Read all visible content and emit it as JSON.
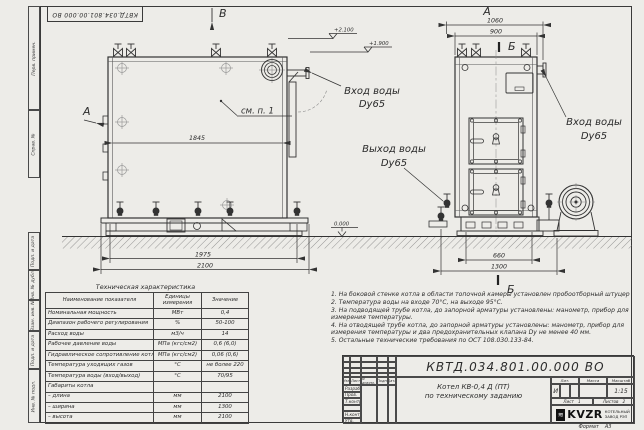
{
  "page": {
    "paper_color": "#edece8",
    "line_color": "#333333"
  },
  "stamp": {
    "text": "КВТД.034.801.00.000 ВО"
  },
  "frame": {
    "cells": [
      "Перв. примен.",
      "Справ. №",
      "Подп. и дата",
      "Инв. № дубл.",
      "Взам. инв. №",
      "Подп. и дата",
      "Инв. № подл."
    ]
  },
  "views": {
    "side": {
      "view_letter": "В",
      "arrow_letter": "А",
      "note_ref": "см. п. 1",
      "dim_inner": "1845",
      "dim_base": "1975",
      "dim_overall": "2100",
      "elev_top": "+2.100",
      "elev_inlet": "+1.900",
      "elev_zero": "0.000",
      "inlet_line1": "Вход воды",
      "inlet_line2": "Dy65"
    },
    "front": {
      "view_letter": "А",
      "section_letter": "Б",
      "dim_overall_top": "1060",
      "dim_body": "900",
      "dim_base": "660",
      "dim_overall_bottom": "1300",
      "inlet_line1": "Вход воды",
      "inlet_line2": "Dy65",
      "outlet_line1": "Выход воды",
      "outlet_line2": "Dy65"
    }
  },
  "spec_table": {
    "title": "Техническая характеристика",
    "headers": [
      "Наименование показателя",
      "Единицы измерения",
      "Значение"
    ],
    "rows": [
      [
        "Номинальная мощность",
        "МВт",
        "0,4"
      ],
      [
        "Диапазон рабочего регулирования",
        "%",
        "50-100"
      ],
      [
        "Расход воды",
        "м3/ч",
        "14"
      ],
      [
        "Рабочее давление воды",
        "МПа (кгс/см2)",
        "0,6 (6,0)"
      ],
      [
        "Гидравлическое сопротивление котла",
        "МПа (кгс/см2)",
        "0,06 (0,6)"
      ],
      [
        "Температура уходящих газов",
        "°С",
        "не более 220"
      ],
      [
        "Температура воды (вход/выход)",
        "°С",
        "70/95"
      ],
      [
        "Габариты котла",
        "",
        ""
      ],
      [
        "– длина",
        "мм",
        "2100"
      ],
      [
        "– ширина",
        "мм",
        "1300"
      ],
      [
        "– высота",
        "мм",
        "2100"
      ]
    ]
  },
  "notes": [
    "1.  На боковой стенке котла в области топочной камеры установлен пробоотборный штуцер",
    "2.  Температура воды на входе 70°С, на выходе 95°С.",
    "3.  На подводящей трубе котла, до запорной арматуры установлены: манометр, прибор для измерения температуры.",
    "4.  На отводящей трубе котла, до запорной арматуры установлены: манометр, прибор для измерения температуры и два предохранительных клапана Dу не менее 40 мм.",
    "5.  Остальные технические требования по ОСТ 108.030.133-84."
  ],
  "title_block": {
    "doc_number": "КВТД.034.801.00.000  ВО",
    "product_line1": "Котел  КВ-0,4  Д  (ПТ)",
    "product_line2": "по техническому заданию",
    "cols": [
      "Изм",
      "Лист",
      "N докум.",
      "Подп.",
      "Дата"
    ],
    "sig_rows": [
      "Разраб.",
      "Пров.",
      "Т.контр.",
      "",
      "Н.контр.",
      "Утв."
    ],
    "lit_label": "Лит.",
    "mass_label": "Масса",
    "scale_label": "Масштаб",
    "lit_value": "И",
    "scale_value": "1:15",
    "sheet_label": "Лист",
    "sheet_value": "1",
    "sheets_label": "Листов",
    "sheets_value": "2",
    "logo_glyph": "≋",
    "logo_text": "KVZR",
    "company_line1": "КОТЕЛЬНЫЙ",
    "company_line2": "ЗАВОД РЭП",
    "format_label": "Формат",
    "format_value": "А3"
  }
}
